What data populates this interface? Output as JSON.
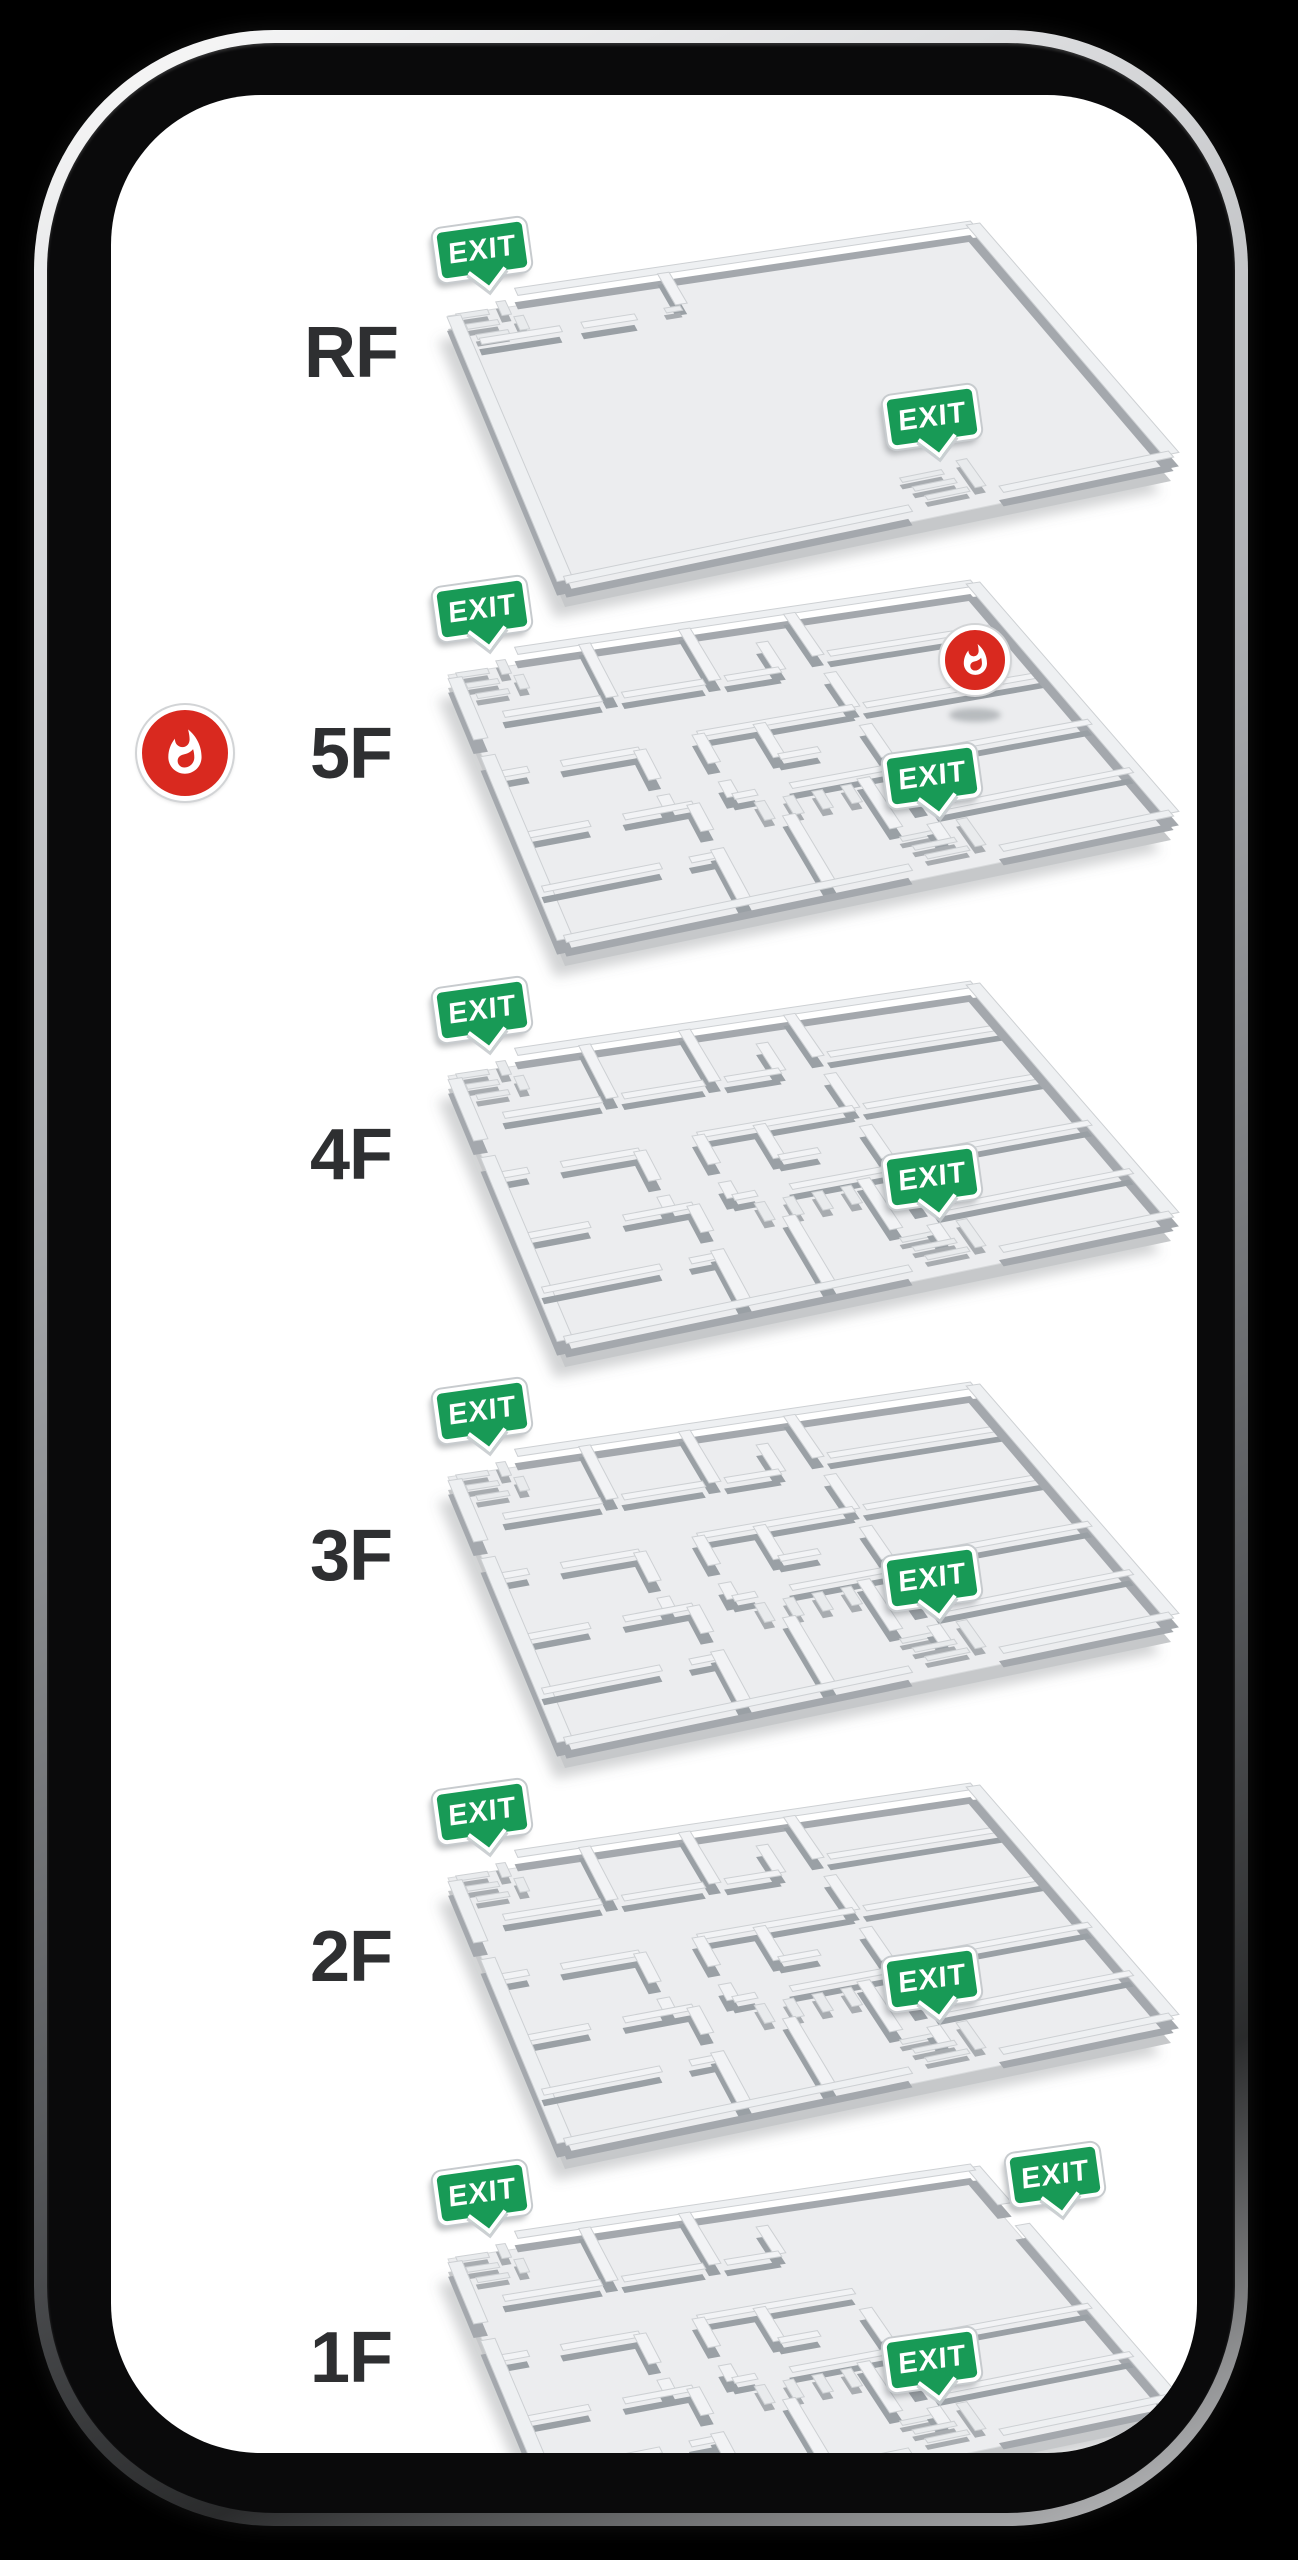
{
  "device": {
    "kind": "smartphone mockup",
    "screen_background": "#ffffff",
    "frame_color": "#0a0a0b"
  },
  "exit_label": "EXIT",
  "colors": {
    "exit_green": "#189a56",
    "fire_red": "#d9291f",
    "slab": "#ecedef",
    "slab_edge": "#c6c8ca",
    "wall_top": "#f2f3f5",
    "wall_side": "#9aa0a5",
    "label_text": "#2e2f31"
  },
  "floors": [
    {
      "id": "rf",
      "label": "RF",
      "layout": "roof",
      "fire_alarm": false,
      "fire_on_plan": false,
      "exits": [
        {
          "location": "northwest"
        },
        {
          "location": "southeast"
        }
      ]
    },
    {
      "id": "5f",
      "label": "5F",
      "layout": "maze",
      "fire_alarm": true,
      "fire_on_plan": true,
      "exits": [
        {
          "location": "northwest"
        },
        {
          "location": "southeast"
        }
      ]
    },
    {
      "id": "4f",
      "label": "4F",
      "layout": "maze",
      "fire_alarm": false,
      "fire_on_plan": false,
      "exits": [
        {
          "location": "northwest"
        },
        {
          "location": "southeast"
        }
      ]
    },
    {
      "id": "3f",
      "label": "3F",
      "layout": "maze",
      "fire_alarm": false,
      "fire_on_plan": false,
      "exits": [
        {
          "location": "northwest"
        },
        {
          "location": "southeast"
        }
      ]
    },
    {
      "id": "2f",
      "label": "2F",
      "layout": "maze",
      "fire_alarm": false,
      "fire_on_plan": false,
      "exits": [
        {
          "location": "northwest"
        },
        {
          "location": "southeast"
        }
      ]
    },
    {
      "id": "1f",
      "label": "1F",
      "layout": "ground",
      "fire_alarm": false,
      "fire_on_plan": false,
      "exits": [
        {
          "location": "northwest"
        },
        {
          "location": "northeast"
        },
        {
          "location": "southeast"
        }
      ]
    }
  ]
}
